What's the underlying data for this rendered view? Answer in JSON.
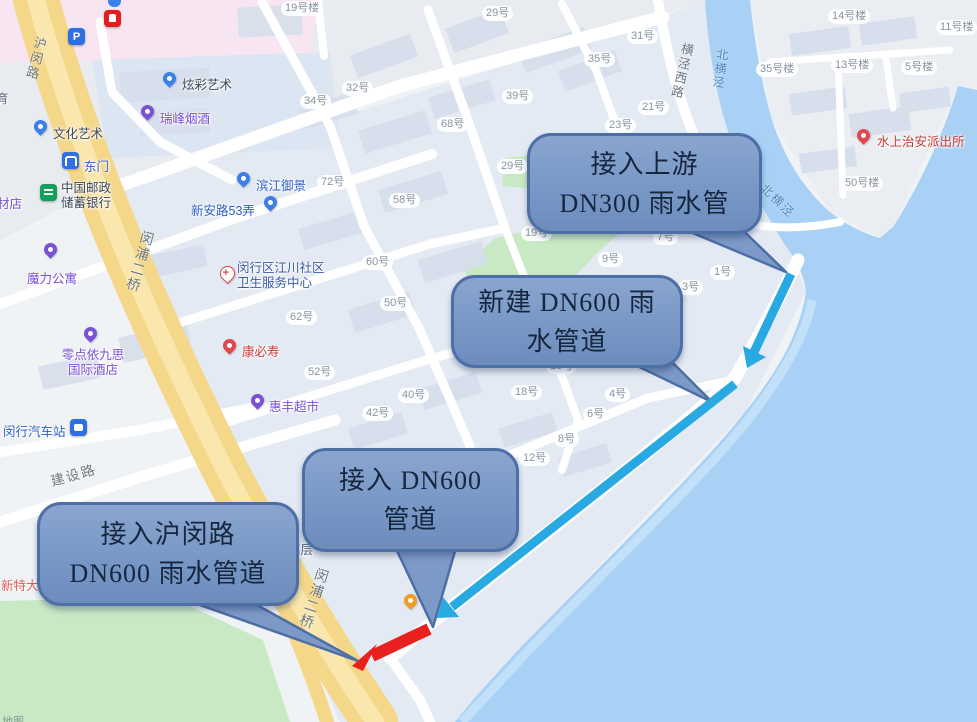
{
  "callouts": [
    {
      "line1": "接入上游",
      "line2": "DN300 雨水管"
    },
    {
      "line1": "新建 DN600 雨",
      "line2": "水管道"
    },
    {
      "line1": "接入 DN600",
      "line2": "管道"
    },
    {
      "line1": "接入沪闵路",
      "line2": "DN600 雨水管道"
    }
  ],
  "bnum": [
    "19号楼",
    "29号",
    "31号",
    "35号",
    "32号",
    "34号",
    "39号",
    "68号",
    "23号",
    "21号",
    "29号",
    "72号",
    "58号",
    "19号",
    "7号",
    "9号",
    "1号",
    "3号",
    "60号",
    "50号",
    "62号",
    "52号",
    "40号",
    "42号",
    "18号",
    "16号",
    "4号",
    "6号",
    "8号",
    "12号",
    "14号楼",
    "11号楼",
    "35号楼",
    "13号楼",
    "5号楼",
    "50号楼"
  ],
  "poi": {
    "xuancai": "炫彩艺术",
    "ruifeng": "瑞峰烟酒",
    "wenhua": "文化艺术",
    "dongmen": "东门",
    "post_l1": "中国邮政",
    "post_l2": "储蓄银行",
    "moli": "魔力公寓",
    "hotel_l1": "零点依九思",
    "hotel_l2": "国际酒店",
    "bus_station": "闵行汽车站",
    "kangbishou": "康必寿",
    "huifeng": "惠丰超市",
    "binjiang": "滨江御景",
    "xinanlu53": "新安路53弄",
    "health_l1": "闵行区江川社区",
    "health_l2": "卫生服务中心",
    "police": "水上治安派出所",
    "gaoceng": "高层",
    "xinteda_partial": "新特大",
    "caidian_partial": "材店",
    "yu_partial": "育",
    "parking_glyph": "P"
  },
  "roads": {
    "huminlu": "沪闵路",
    "minpu_bridge": "闵浦二桥",
    "jianshe": "建设路",
    "hengjing_west": "横泾西路",
    "beihengjing": "北横泾"
  },
  "watermark": "地图",
  "colors": {
    "callout_fill": "#7C99C7",
    "callout_border": "#4C6FA6",
    "callout_text": "#16263F",
    "arrow_blue": "#29A9E1",
    "arrow_red": "#E8201E",
    "water": "#A8D1F5",
    "park_green": "#C9E9C4",
    "road_yellow": "#F5D78A",
    "pink_block": "#F7E5F2"
  }
}
